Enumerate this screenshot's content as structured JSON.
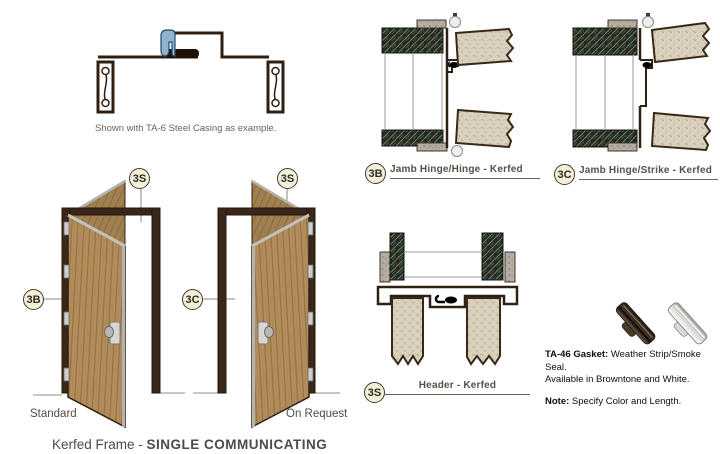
{
  "page": {
    "title_regular": "Kerfed Frame - ",
    "title_bold": "SINGLE COMMUNICATING"
  },
  "profile_drawing": {
    "caption": "Shown with TA-6 Steel Casing as example.",
    "casing_clip_color": "#8fb4cf",
    "frame_color": "#2f1f12"
  },
  "sections": {
    "jamb_hinge_hinge": {
      "badge": "3B",
      "label": "Jamb Hinge/Hinge - Kerfed"
    },
    "jamb_hinge_strike": {
      "badge": "3C",
      "label": "Jamb Hinge/Strike - Kerfed"
    },
    "header": {
      "badge": "3S",
      "label": "Header - Kerfed"
    }
  },
  "doors": {
    "standard": {
      "label": "Standard",
      "badge_top": "3S",
      "badge_side": "3B"
    },
    "on_request": {
      "label": "On Request",
      "badge_top": "3S",
      "badge_side": "3C"
    },
    "wood_color": "#b28e5c",
    "frame_color": "#38271a"
  },
  "gasket": {
    "line1_bold": "TA-46 Gasket:",
    "line1_rest": " Weather Strip/Smoke Seal.",
    "line2": "Available in Browntone and White.",
    "note_bold": "Note:",
    "note_rest": " Specify Color and Length.",
    "browntone_color": "#4f3f2d",
    "white_color": "#e9e9e6"
  }
}
